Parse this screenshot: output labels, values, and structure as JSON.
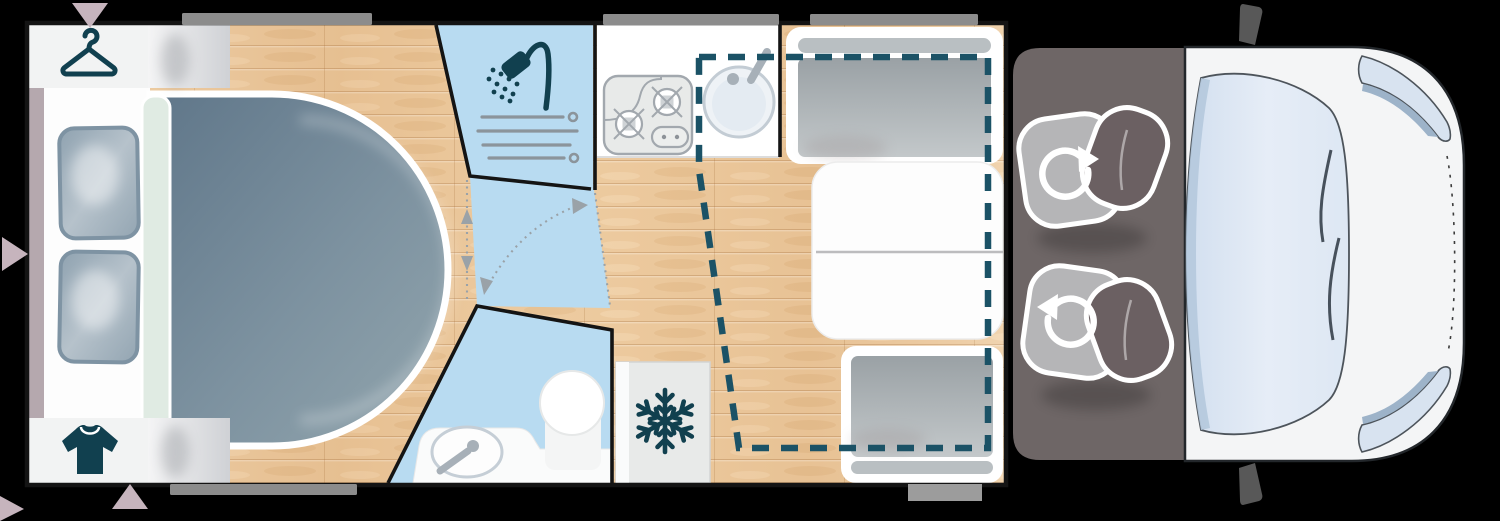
{
  "scene": {
    "type": "floorplan-illustration",
    "subject": "Motorhome / camper van floor plan, top-down view, cab at right",
    "text_content": "none - purely graphical diagram"
  },
  "colors": {
    "background": "#000000",
    "plan_wall": "#141414",
    "floor_wood": "#ecca9f",
    "wet_room_blue": "#b8dbf1",
    "icon_teal": "#11404f",
    "dropdown_bed_dash": "#1b5266",
    "mattress_dark": "#5f7689",
    "mattress_light": "#93a6ae",
    "pillow_fill": "#a2b1bd",
    "pillow_edge": "#7e93a3",
    "duvet_mint": "#e0ebe3",
    "headboard_pink": "#b5a8ae",
    "arrow_pink": "#c6b4bd",
    "cabinet_white": "#f2f3f3",
    "cabinet_gray": "#cfd1d5",
    "window_bar_gray": "#8c8c8c",
    "entry_step_gray": "#9c9c9c",
    "counter_white": "#ffffff",
    "appliance_gray": "#e8eae9",
    "appliance_line": "#a2a8ae",
    "sink_blue": "#eef2f6",
    "fixture_gray": "#a7b0b8",
    "cushion_gray": "#aab0b3",
    "headrest_gray": "#b9bfc2",
    "table_white": "#fdfdfd",
    "cab_floor": "#6e6666",
    "seat_cushion": "#b5b5b7",
    "seat_back": "#6b6062",
    "body_white": "#f4f5f6",
    "body_outline": "#23272b",
    "glass_blue": "#dfe8f4",
    "glass_edge": "#b5c9dd",
    "mirror_gray": "#585858",
    "partition_dot_gray": "#9aa2a8"
  },
  "rooms": [
    {
      "id": "bedroom",
      "name": "Rear bedroom",
      "features": [
        "island bed with rounded foot",
        "two pillows",
        "wardrobe (hanger icon)",
        "clothes cabinet (t-shirt icon)"
      ]
    },
    {
      "id": "shower",
      "name": "Shower cabin",
      "features": [
        "shower-head icon",
        "shower screen slats"
      ]
    },
    {
      "id": "washroom",
      "name": "Washroom",
      "features": [
        "toilet",
        "washbasin with tap",
        "pivoting partition shown with dotted arc and arrows"
      ]
    },
    {
      "id": "kitchen",
      "name": "Kitchenette",
      "features": [
        "two-burner hob with control pad",
        "round sink with tap"
      ]
    },
    {
      "id": "fridge",
      "name": "Refrigerator",
      "features": [
        "snowflake icon"
      ]
    },
    {
      "id": "dinette",
      "name": "Dinette / lounge",
      "features": [
        "forward bench seat with headrest",
        "split folding table",
        "rear bench seat with headrest",
        "drop-down bed outline (teal dashed rectangle)"
      ]
    },
    {
      "id": "cab",
      "name": "Driver cab",
      "features": [
        "two swivel seats with rotation arrows",
        "windshield with wipers",
        "two side windows",
        "two exterior mirrors"
      ]
    }
  ],
  "icons": [
    {
      "name": "hanger-icon",
      "meaning": "wardrobe"
    },
    {
      "name": "tshirt-icon",
      "meaning": "clothes storage"
    },
    {
      "name": "shower-icon",
      "meaning": "shower"
    },
    {
      "name": "snowflake-icon",
      "meaning": "fridge / freezer"
    },
    {
      "name": "swivel-arrow-icon",
      "meaning": "seat rotates"
    },
    {
      "name": "toilet-icon",
      "meaning": "toilet"
    },
    {
      "name": "washbasin-icon",
      "meaning": "washbasin"
    },
    {
      "name": "hob-icon",
      "meaning": "gas hob"
    },
    {
      "name": "sink-icon",
      "meaning": "kitchen sink"
    }
  ],
  "markers": {
    "window_bars_top": 3,
    "window_bars_bottom": 1,
    "entry_step_bars": 1,
    "direction_arrows_pink": 4,
    "dropdown_bed_outline": "dashed teal rectangle over kitchen and dinette",
    "door_swing": "dotted grey arc with arrowheads in washroom corridor"
  }
}
